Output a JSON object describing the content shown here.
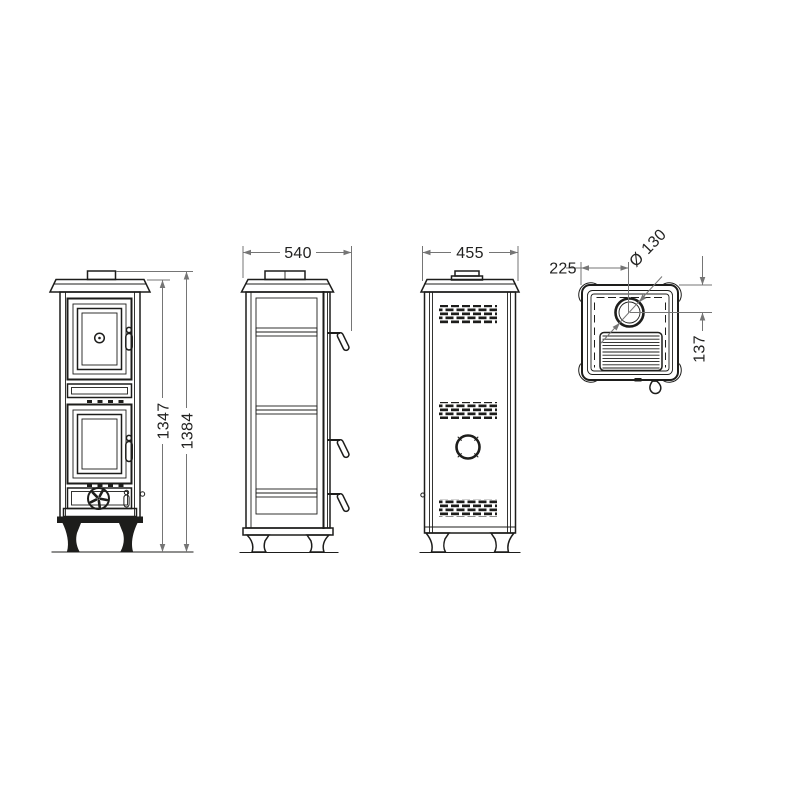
{
  "drawing": {
    "colors": {
      "background": "#ffffff",
      "ink": "#1d1d1b",
      "dimension_lines": "#757575"
    },
    "views": {
      "front": {
        "dimensions": {
          "height_to_top_plate": "1347",
          "height_overall": "1384"
        }
      },
      "side": {
        "dimensions": {
          "depth_overall": "540"
        }
      },
      "rear": {
        "dimensions": {
          "width_overall": "455"
        }
      },
      "top": {
        "dimensions": {
          "flue_center_from_side": "225",
          "flue_diameter": "Ø 130",
          "flue_center_from_back": "137"
        }
      }
    }
  }
}
